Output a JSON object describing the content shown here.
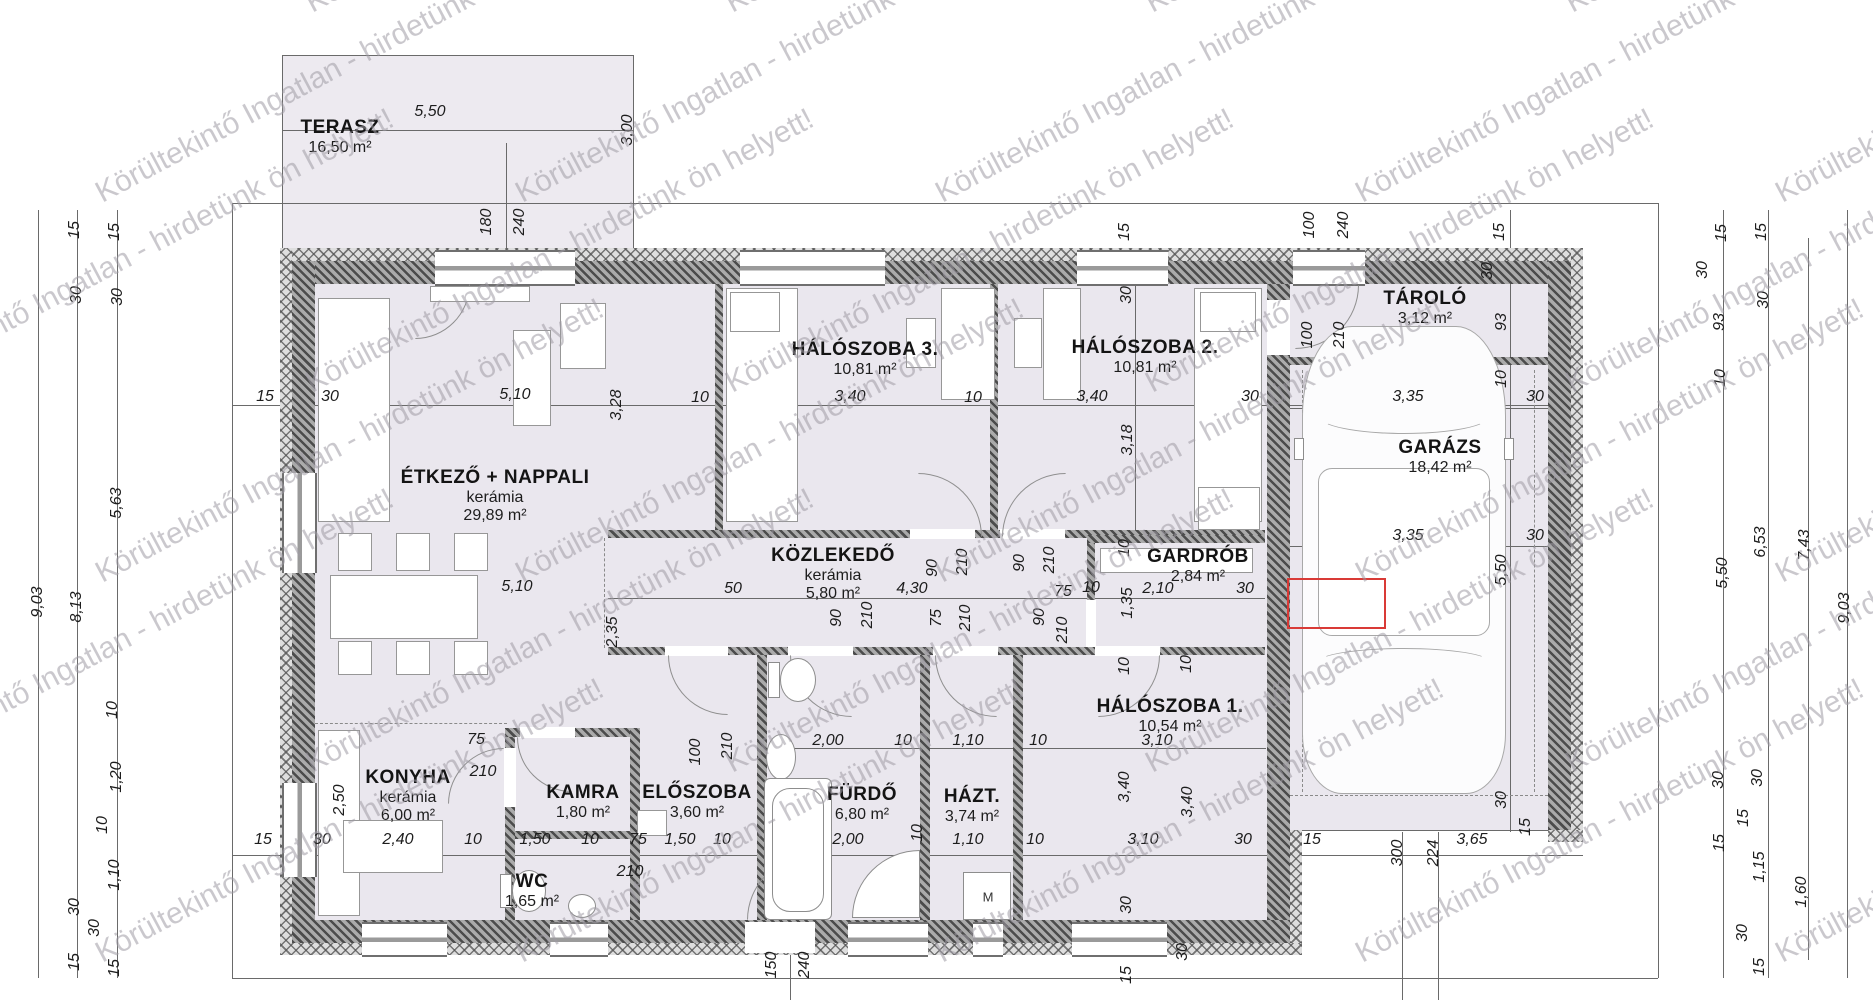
{
  "watermark": {
    "text": "Körültekintő Ingatlan - hirdetünk ön helyett!"
  },
  "colors": {
    "room_fill": "#eae7ee",
    "wall": "#8a8a8a",
    "highlight": "#d93a36"
  },
  "labels": {
    "washer": "M"
  },
  "rooms": [
    {
      "name": "TERASZ",
      "area": "16,50 m²",
      "x": 340,
      "y": 128
    },
    {
      "name": "ÉTKEZŐ + NAPPALI",
      "material": "kerámia",
      "area": "29,89 m²",
      "x": 495,
      "y": 478
    },
    {
      "name": "HÁLÓSZOBA 3.",
      "area": "10,81 m²",
      "x": 865,
      "y": 350
    },
    {
      "name": "HÁLÓSZOBA 2.",
      "area": "10,81 m²",
      "x": 1145,
      "y": 348
    },
    {
      "name": "TÁROLÓ",
      "area": "3,12 m²",
      "x": 1425,
      "y": 299
    },
    {
      "name": "GARÁZS",
      "area": "18,42 m²",
      "x": 1440,
      "y": 448
    },
    {
      "name": "KÖZLEKEDŐ",
      "material": "kerámia",
      "area": "5,80 m²",
      "x": 833,
      "y": 556
    },
    {
      "name": "GARDRÓB",
      "area": "2,84 m²",
      "x": 1198,
      "y": 557
    },
    {
      "name": "HÁLÓSZOBA 1.",
      "area": "10,54 m²",
      "x": 1170,
      "y": 707
    },
    {
      "name": "KONYHA",
      "material": "kerámia",
      "area": "6,00 m²",
      "x": 408,
      "y": 778
    },
    {
      "name": "KAMRA",
      "area": "1,80 m²",
      "x": 583,
      "y": 793
    },
    {
      "name": "ELŐSZOBA",
      "area": "3,60 m²",
      "x": 697,
      "y": 793
    },
    {
      "name": "FÜRDŐ",
      "area": "6,80 m²",
      "x": 862,
      "y": 795
    },
    {
      "name": "HÁZT.",
      "area": "3,74 m²",
      "x": 972,
      "y": 797
    },
    {
      "name": "WC",
      "area": "1,65 m²",
      "x": 532,
      "y": 882
    }
  ],
  "dims": [
    {
      "t": "5,50",
      "x": 430,
      "y": 112,
      "r": 0
    },
    {
      "t": "3,00",
      "x": 628,
      "y": 130,
      "r": -90
    },
    {
      "t": "180",
      "x": 487,
      "y": 222,
      "r": -90
    },
    {
      "t": "240",
      "x": 520,
      "y": 222,
      "r": -90
    },
    {
      "t": "100",
      "x": 1310,
      "y": 225,
      "r": -90
    },
    {
      "t": "240",
      "x": 1344,
      "y": 225,
      "r": -90
    },
    {
      "t": "15",
      "x": 1125,
      "y": 232,
      "r": -90
    },
    {
      "t": "30",
      "x": 1127,
      "y": 295,
      "r": -90
    },
    {
      "t": "100",
      "x": 1308,
      "y": 335,
      "r": -90
    },
    {
      "t": "210",
      "x": 1340,
      "y": 335,
      "r": -90
    },
    {
      "t": "9,03",
      "x": 38,
      "y": 602,
      "r": -90
    },
    {
      "t": "15",
      "x": 75,
      "y": 230,
      "r": -90
    },
    {
      "t": "30",
      "x": 77,
      "y": 295,
      "r": -90
    },
    {
      "t": "8,13",
      "x": 77,
      "y": 607,
      "r": -90
    },
    {
      "t": "30",
      "x": 75,
      "y": 907,
      "r": -90
    },
    {
      "t": "15",
      "x": 75,
      "y": 962,
      "r": -90
    },
    {
      "t": "15",
      "x": 115,
      "y": 232,
      "r": -90
    },
    {
      "t": "30",
      "x": 118,
      "y": 297,
      "r": -90
    },
    {
      "t": "5,63",
      "x": 117,
      "y": 503,
      "r": -90
    },
    {
      "t": "10",
      "x": 113,
      "y": 710,
      "r": -90
    },
    {
      "t": "1,20",
      "x": 117,
      "y": 777,
      "r": -90
    },
    {
      "t": "10",
      "x": 103,
      "y": 825,
      "r": -90
    },
    {
      "t": "1,10",
      "x": 115,
      "y": 875,
      "r": -90
    },
    {
      "t": "30",
      "x": 95,
      "y": 928,
      "r": -90
    },
    {
      "t": "15",
      "x": 115,
      "y": 968,
      "r": -90
    },
    {
      "t": "15",
      "x": 1722,
      "y": 233,
      "r": -90
    },
    {
      "t": "30",
      "x": 1703,
      "y": 270,
      "r": -90
    },
    {
      "t": "93",
      "x": 1720,
      "y": 322,
      "r": -90
    },
    {
      "t": "10",
      "x": 1721,
      "y": 378,
      "r": -90
    },
    {
      "t": "5,50",
      "x": 1723,
      "y": 573,
      "r": -90
    },
    {
      "t": "30",
      "x": 1719,
      "y": 780,
      "r": -90
    },
    {
      "t": "15",
      "x": 1720,
      "y": 843,
      "r": -90
    },
    {
      "t": "15",
      "x": 1762,
      "y": 232,
      "r": -90
    },
    {
      "t": "30",
      "x": 1764,
      "y": 300,
      "r": -90
    },
    {
      "t": "6,53",
      "x": 1761,
      "y": 542,
      "r": -90
    },
    {
      "t": "30",
      "x": 1758,
      "y": 778,
      "r": -90
    },
    {
      "t": "15",
      "x": 1744,
      "y": 818,
      "r": -90
    },
    {
      "t": "1,15",
      "x": 1760,
      "y": 867,
      "r": -90
    },
    {
      "t": "30",
      "x": 1743,
      "y": 933,
      "r": -90
    },
    {
      "t": "15",
      "x": 1760,
      "y": 967,
      "r": -90
    },
    {
      "t": "7,43",
      "x": 1805,
      "y": 545,
      "r": -90
    },
    {
      "t": "1,60",
      "x": 1802,
      "y": 892,
      "r": -90
    },
    {
      "t": "9,03",
      "x": 1845,
      "y": 608,
      "r": -90
    },
    {
      "t": "15",
      "x": 1500,
      "y": 232,
      "r": -90
    },
    {
      "t": "30",
      "x": 1488,
      "y": 271,
      "r": -90
    },
    {
      "t": "93",
      "x": 1502,
      "y": 322,
      "r": -90
    },
    {
      "t": "10",
      "x": 1502,
      "y": 379,
      "r": -90
    },
    {
      "t": "5,50",
      "x": 1502,
      "y": 570,
      "r": -90
    },
    {
      "t": "3,35",
      "x": 1408,
      "y": 397,
      "r": 0
    },
    {
      "t": "30",
      "x": 1535,
      "y": 397,
      "r": 0
    },
    {
      "t": "3,35",
      "x": 1408,
      "y": 536,
      "r": 0
    },
    {
      "t": "30",
      "x": 1535,
      "y": 536,
      "r": 0
    },
    {
      "t": "15",
      "x": 265,
      "y": 397,
      "r": 0
    },
    {
      "t": "30",
      "x": 330,
      "y": 397,
      "r": 0
    },
    {
      "t": "5,10",
      "x": 515,
      "y": 395,
      "r": 0
    },
    {
      "t": "3,28",
      "x": 617,
      "y": 405,
      "r": -90
    },
    {
      "t": "10",
      "x": 700,
      "y": 398,
      "r": 0
    },
    {
      "t": "3,40",
      "x": 850,
      "y": 397,
      "r": 0
    },
    {
      "t": "10",
      "x": 973,
      "y": 398,
      "r": 0
    },
    {
      "t": "3,40",
      "x": 1092,
      "y": 397,
      "r": 0
    },
    {
      "t": "3,18",
      "x": 1128,
      "y": 440,
      "r": -90
    },
    {
      "t": "30",
      "x": 1250,
      "y": 397,
      "r": 0
    },
    {
      "t": "5,10",
      "x": 517,
      "y": 587,
      "r": 0
    },
    {
      "t": "2,35",
      "x": 613,
      "y": 632,
      "r": -90
    },
    {
      "t": "50",
      "x": 733,
      "y": 589,
      "r": 0
    },
    {
      "t": "4,30",
      "x": 912,
      "y": 589,
      "r": 0
    },
    {
      "t": "75",
      "x": 1063,
      "y": 592,
      "r": 0
    },
    {
      "t": "10",
      "x": 1091,
      "y": 588,
      "r": 0
    },
    {
      "t": "90",
      "x": 933,
      "y": 568,
      "r": -90
    },
    {
      "t": "210",
      "x": 963,
      "y": 562,
      "r": -90
    },
    {
      "t": "90",
      "x": 1020,
      "y": 563,
      "r": -90
    },
    {
      "t": "210",
      "x": 1050,
      "y": 560,
      "r": -90
    },
    {
      "t": "90",
      "x": 837,
      "y": 618,
      "r": -90
    },
    {
      "t": "210",
      "x": 868,
      "y": 615,
      "r": -90
    },
    {
      "t": "75",
      "x": 937,
      "y": 618,
      "r": -90
    },
    {
      "t": "210",
      "x": 966,
      "y": 618,
      "r": -90
    },
    {
      "t": "90",
      "x": 1040,
      "y": 617,
      "r": -90
    },
    {
      "t": "210",
      "x": 1063,
      "y": 630,
      "r": -90
    },
    {
      "t": "10",
      "x": 1125,
      "y": 548,
      "r": -90
    },
    {
      "t": "1,35",
      "x": 1128,
      "y": 603,
      "r": -90
    },
    {
      "t": "2,10",
      "x": 1158,
      "y": 589,
      "r": 0
    },
    {
      "t": "30",
      "x": 1245,
      "y": 589,
      "r": 0
    },
    {
      "t": "10",
      "x": 1125,
      "y": 666,
      "r": -90
    },
    {
      "t": "10",
      "x": 1187,
      "y": 664,
      "r": -90
    },
    {
      "t": "2,00",
      "x": 828,
      "y": 741,
      "r": 0
    },
    {
      "t": "10",
      "x": 903,
      "y": 741,
      "r": 0
    },
    {
      "t": "1,10",
      "x": 968,
      "y": 741,
      "r": 0
    },
    {
      "t": "10",
      "x": 1038,
      "y": 741,
      "r": 0
    },
    {
      "t": "3,10",
      "x": 1157,
      "y": 741,
      "r": 0
    },
    {
      "t": "3,40",
      "x": 1125,
      "y": 787,
      "r": -90
    },
    {
      "t": "3,40",
      "x": 1188,
      "y": 802,
      "r": -90
    },
    {
      "t": "10",
      "x": 918,
      "y": 833,
      "r": -90
    },
    {
      "t": "75",
      "x": 476,
      "y": 740,
      "r": 0
    },
    {
      "t": "210",
      "x": 483,
      "y": 772,
      "r": 0
    },
    {
      "t": "100",
      "x": 696,
      "y": 752,
      "r": -90
    },
    {
      "t": "210",
      "x": 728,
      "y": 746,
      "r": -90
    },
    {
      "t": "2,50",
      "x": 340,
      "y": 800,
      "r": -90
    },
    {
      "t": "15",
      "x": 263,
      "y": 840,
      "r": 0
    },
    {
      "t": "30",
      "x": 322,
      "y": 840,
      "r": 0
    },
    {
      "t": "2,40",
      "x": 398,
      "y": 840,
      "r": 0
    },
    {
      "t": "10",
      "x": 473,
      "y": 840,
      "r": 0
    },
    {
      "t": "1,50",
      "x": 535,
      "y": 840,
      "r": 0
    },
    {
      "t": "10",
      "x": 590,
      "y": 840,
      "r": 0
    },
    {
      "t": "75",
      "x": 638,
      "y": 840,
      "r": 0
    },
    {
      "t": "1,50",
      "x": 680,
      "y": 840,
      "r": 0
    },
    {
      "t": "10",
      "x": 722,
      "y": 840,
      "r": 0
    },
    {
      "t": "2,00",
      "x": 848,
      "y": 840,
      "r": 0
    },
    {
      "t": "1,10",
      "x": 968,
      "y": 840,
      "r": 0
    },
    {
      "t": "10",
      "x": 1035,
      "y": 840,
      "r": 0
    },
    {
      "t": "3,10",
      "x": 1143,
      "y": 840,
      "r": 0
    },
    {
      "t": "30",
      "x": 1243,
      "y": 840,
      "r": 0
    },
    {
      "t": "15",
      "x": 1312,
      "y": 840,
      "r": 0
    },
    {
      "t": "3,65",
      "x": 1472,
      "y": 840,
      "r": 0
    },
    {
      "t": "210",
      "x": 630,
      "y": 872,
      "r": 0
    },
    {
      "t": "30",
      "x": 1502,
      "y": 800,
      "r": -90
    },
    {
      "t": "15",
      "x": 1526,
      "y": 827,
      "r": -90
    },
    {
      "t": "300",
      "x": 1398,
      "y": 853,
      "r": -90
    },
    {
      "t": "224",
      "x": 1434,
      "y": 853,
      "r": -90
    },
    {
      "t": "150",
      "x": 772,
      "y": 965,
      "r": -90
    },
    {
      "t": "240",
      "x": 805,
      "y": 965,
      "r": -90
    },
    {
      "t": "30",
      "x": 1127,
      "y": 905,
      "r": -90
    },
    {
      "t": "15",
      "x": 1127,
      "y": 975,
      "r": -90
    },
    {
      "t": "30",
      "x": 1183,
      "y": 952,
      "r": -90
    }
  ]
}
